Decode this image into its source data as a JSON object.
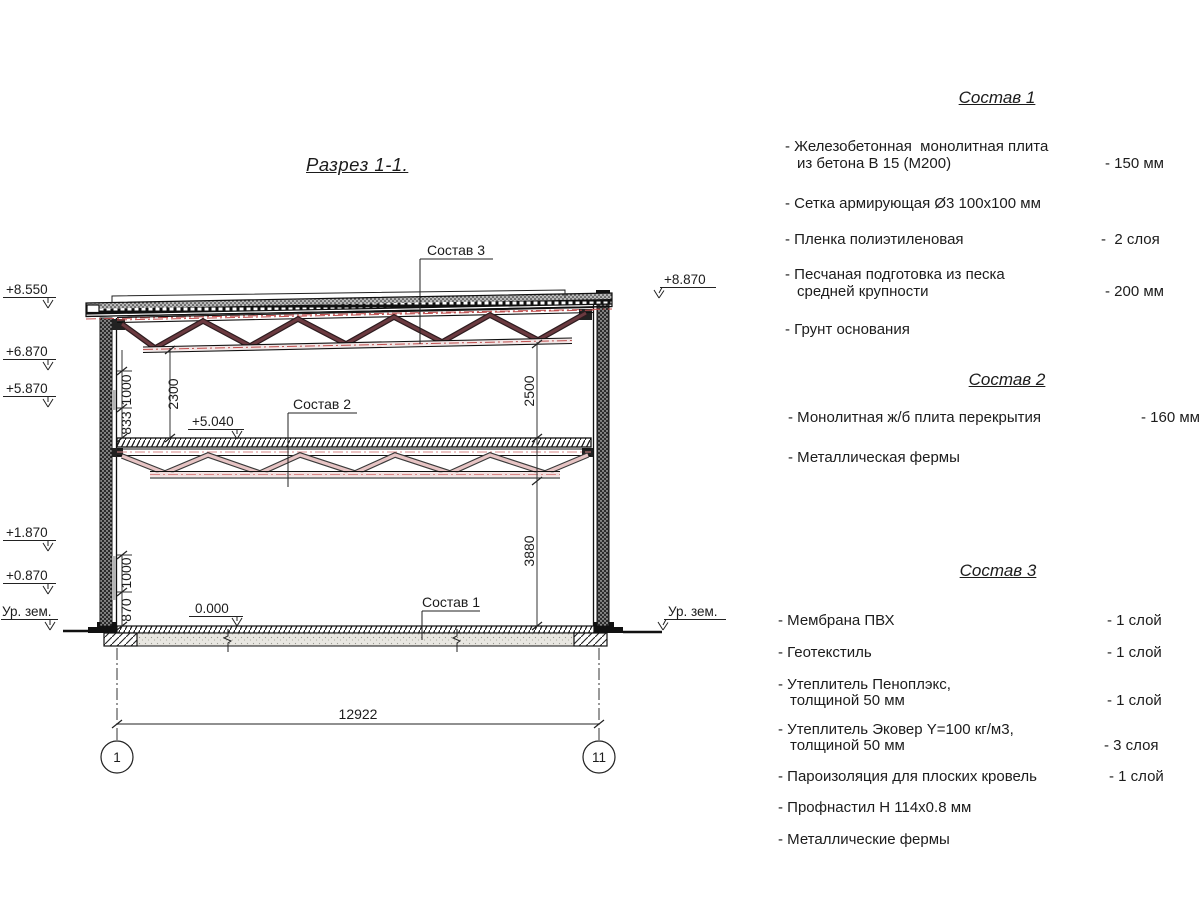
{
  "title": "Разрез 1-1.",
  "drawing": {
    "marks": {
      "m8550": "+8.550",
      "m6870": "+6.870",
      "m5870": "+5.870",
      "m1870": "+1.870",
      "m0870": "+0.870",
      "ur_zem_left": "Ур. зем.",
      "m8870": "+8.870",
      "ur_zem_right": "Ур. зем.",
      "m5040": "+5.040",
      "m0000": "0.000"
    },
    "dims": {
      "upper_1000": "1000",
      "upper_833": "833",
      "left_2300": "2300",
      "right_2500": "2500",
      "lower_1000": "1000",
      "lower_870": "870",
      "right_3880": "3880",
      "overall": "12922"
    },
    "leaders": {
      "sostav3": "Состав 3",
      "sostav2": "Состав 2",
      "sostav1": "Состав 1"
    },
    "axes": {
      "left": "1",
      "right": "11"
    }
  },
  "panel": {
    "sections": [
      {
        "header": "Состав 1",
        "items": [
          {
            "lines": [
              "- Железобетонная  монолитная плита",
              "из бетона В 15 (М200)"
            ],
            "value": "- 150 мм"
          },
          {
            "lines": [
              "- Сетка армирующая Ø3 100х100 мм"
            ],
            "value": ""
          },
          {
            "lines": [
              "- Пленка полиэтиленовая"
            ],
            "value": "-  2 слоя"
          },
          {
            "lines": [
              "- Песчаная подготовка из песка",
              "средней крупности"
            ],
            "value": "- 200 мм"
          },
          {
            "lines": [
              "- Грунт основания"
            ],
            "value": ""
          }
        ]
      },
      {
        "header": "Состав 2",
        "items": [
          {
            "lines": [
              "- Монолитная ж/б плита перекрытия"
            ],
            "value": "- 160 мм"
          },
          {
            "lines": [
              "- Металлическая фермы"
            ],
            "value": ""
          }
        ]
      },
      {
        "header": "Состав 3",
        "items": [
          {
            "lines": [
              "- Мембрана ПВХ"
            ],
            "value": "- 1 слой"
          },
          {
            "lines": [
              "- Геотекстиль"
            ],
            "value": "- 1 слой"
          },
          {
            "lines": [
              "- Утеплитель Пеноплэкс,",
              "толщиной 50 мм"
            ],
            "value": "- 1 слой"
          },
          {
            "lines": [
              "- Утеплитель Эковер Y=100 кг/м3,",
              "толщиной 50 мм"
            ],
            "value": "- 3 слоя"
          },
          {
            "lines": [
              "- Пароизоляция для плоских кровель"
            ],
            "value": "- 1 слой"
          },
          {
            "lines": [
              "- Профнастил Н 114х0.8 мм"
            ],
            "value": ""
          },
          {
            "lines": [
              "- Металлические фермы"
            ],
            "value": ""
          }
        ]
      }
    ]
  },
  "colors": {
    "line": "#1c1c1c",
    "truss_upper": "#6b3a40",
    "truss_lower": "#e7c4c4",
    "dash_red": "#c05050"
  }
}
